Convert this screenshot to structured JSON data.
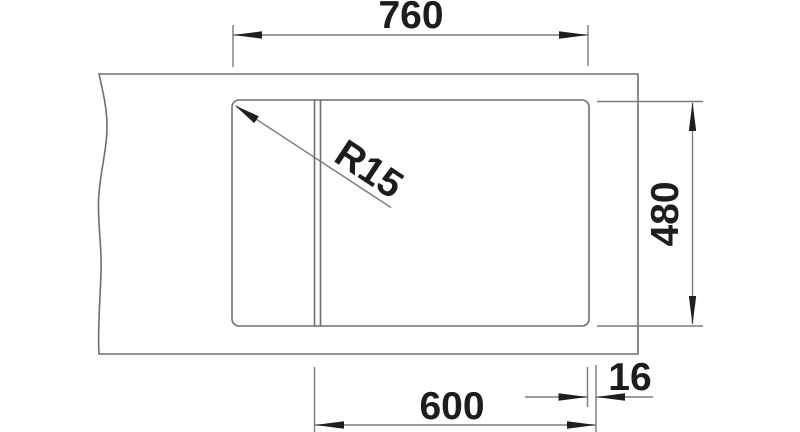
{
  "drawing": {
    "kind": "sink-cutout-dimension-drawing",
    "colors": {
      "background": "#ffffff",
      "geometry_line": "#6f6f71",
      "dimension_line": "#7a7a7c",
      "annotation": "#1d1d1f"
    },
    "dimensions": {
      "overall_width": "760",
      "overall_depth": "480",
      "cabinet_width": "600",
      "edge_offset": "16",
      "corner_radius": "R15"
    }
  }
}
